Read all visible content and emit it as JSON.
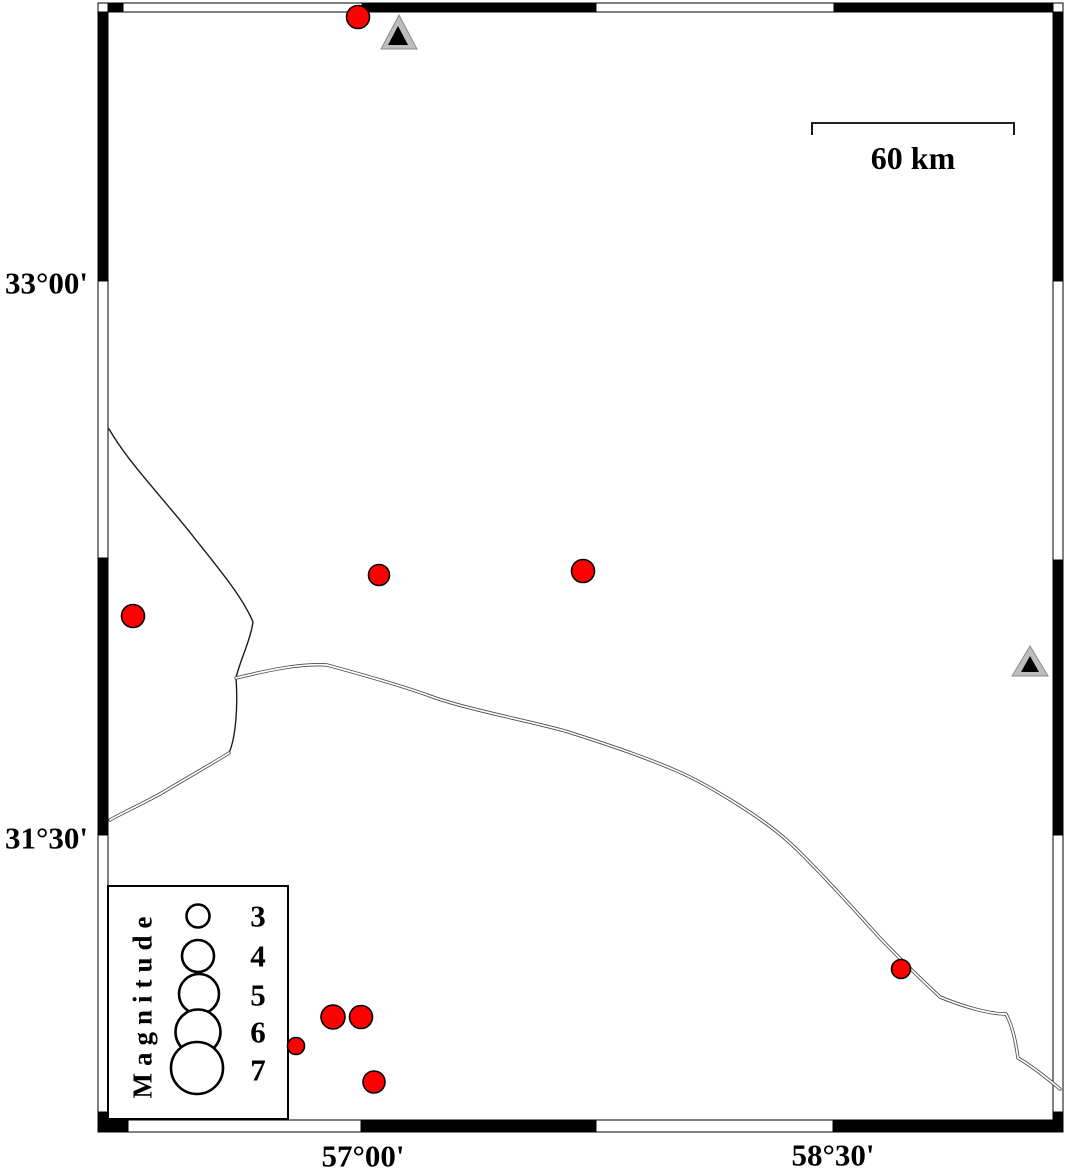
{
  "map": {
    "size": {
      "w": 1066,
      "h": 1171
    },
    "colors": {
      "earthquake_fill": "#ff0000",
      "marker_stroke": "#000000",
      "station_fill": "#bdbdbd",
      "station_inner": "#000000",
      "road_line": "#4a4a4a",
      "boundary_line": "#1c1c1c",
      "frame_black": "#000000",
      "frame_white": "#ffffff"
    },
    "labels": {
      "lat_top": "33°00'",
      "lat_bottom": "31°30'",
      "lon_left": "57°00'",
      "lon_right": "58°30'"
    },
    "label_positions": {
      "lat_top_y": 283,
      "lat_bottom_y": 838,
      "lon_left_x": 363,
      "lon_right_x": 833,
      "lon_y": 1156
    },
    "scale_bar": {
      "label": "60 km",
      "x1": 812,
      "x2": 1014,
      "y": 123,
      "tick_drop": 12,
      "label_x": 913,
      "label_y": 158
    },
    "frame": {
      "bars": [
        {
          "side": "top",
          "a1": 3,
          "a2": 12,
          "cells": [
            [
              98,
              108,
              "w"
            ],
            [
              108,
              123,
              "k"
            ],
            [
              123,
              362,
              "w"
            ],
            [
              362,
              596,
              "k"
            ],
            [
              596,
              834,
              "w"
            ],
            [
              834,
              1053,
              "k"
            ],
            [
              1053,
              1063,
              "w"
            ]
          ]
        },
        {
          "side": "bottom",
          "a1": 1120,
          "a2": 1132,
          "cells": [
            [
              98,
              128,
              "k"
            ],
            [
              128,
              361,
              "w"
            ],
            [
              361,
              596,
              "k"
            ],
            [
              596,
              833,
              "w"
            ],
            [
              833,
              1053,
              "k"
            ],
            [
              1053,
              1063,
              "w"
            ]
          ]
        },
        {
          "side": "left",
          "a1": 98,
          "a2": 108,
          "cells": [
            [
              12,
              281,
              "k"
            ],
            [
              281,
              558,
              "w"
            ],
            [
              558,
              835,
              "k"
            ],
            [
              835,
              1112,
              "w"
            ],
            [
              1112,
              1132,
              "k"
            ]
          ]
        },
        {
          "side": "right",
          "a1": 1053,
          "a2": 1063,
          "cells": [
            [
              3,
              12,
              "w"
            ],
            [
              12,
              281,
              "k"
            ],
            [
              281,
              560,
              "w"
            ],
            [
              560,
              835,
              "k"
            ],
            [
              835,
              1112,
              "w"
            ],
            [
              1112,
              1132,
              "k"
            ]
          ]
        }
      ]
    },
    "legend": {
      "title": "Magnitude",
      "box": {
        "x": 108,
        "y": 886,
        "w": 180,
        "h": 233
      },
      "title_x": 143,
      "title_y": 1004,
      "digit_x": 258,
      "entries": [
        {
          "label": "3",
          "cx": 198,
          "cy": 916,
          "r": 11.5
        },
        {
          "label": "4",
          "cx": 198,
          "cy": 956,
          "r": 16
        },
        {
          "label": "5",
          "cx": 199,
          "cy": 994,
          "r": 20
        },
        {
          "label": "6",
          "cx": 198,
          "cy": 1032,
          "r": 22.5
        },
        {
          "label": "7",
          "cx": 197,
          "cy": 1068,
          "r": 26
        }
      ]
    },
    "earthquakes": [
      {
        "cx": 358,
        "cy": 17,
        "r": 11.5
      },
      {
        "cx": 133,
        "cy": 616,
        "r": 11.5
      },
      {
        "cx": 379,
        "cy": 575,
        "r": 10.5
      },
      {
        "cx": 583,
        "cy": 571,
        "r": 11.5
      },
      {
        "cx": 296,
        "cy": 1046,
        "r": 8.5
      },
      {
        "cx": 333,
        "cy": 1017,
        "r": 12
      },
      {
        "cx": 361,
        "cy": 1017,
        "r": 11.5
      },
      {
        "cx": 374,
        "cy": 1082,
        "r": 11
      },
      {
        "cx": 901,
        "cy": 969,
        "r": 9.5
      }
    ],
    "stations": [
      {
        "outer": "399,15 381,49 417,49",
        "inner": "398,26 388,45 408,45"
      },
      {
        "outer": "1030,646 1012,676 1048,676",
        "inner": "1030,656 1021,672 1039,672"
      }
    ],
    "boundary_paths": [
      "M109,429 C130,465 165,500 196,540 C220,570 243,598 253,622 C250,642 240,660 236,678",
      "M236,678 C238,705 236,737 229,753"
    ],
    "road_paths": [
      "M236,678 C265,671 300,663 327,665 C360,674 400,685 430,696 C465,709 530,721 565,731 C610,745 645,757 677,771 C705,783 762,817 790,843 C815,866 850,905 870,927 C890,950 920,978 940,997 C962,1006 988,1014 1006,1014 C1012,1025 1016,1043 1018,1058 C1032,1066 1048,1079 1060,1089",
      "M229,753 C215,762 190,776 160,794 C140,805 122,813 110,820"
    ]
  },
  "chart_data": {
    "type": "map",
    "title": "",
    "region": {
      "lon_min": 56.15,
      "lon_max": 59.23,
      "lat_min": 30.72,
      "lat_max": 33.75
    },
    "graticule_annotations": {
      "latitudes": [
        "33°00'",
        "31°30'"
      ],
      "longitudes": [
        "57°00'",
        "58°30'"
      ]
    },
    "scale_bar_km": 60,
    "legend": {
      "title": "Magnitude",
      "magnitudes": [
        3,
        4,
        5,
        6,
        7
      ]
    },
    "earthquakes": [
      {
        "lon": 56.98,
        "lat": 33.71,
        "magnitude": 3.0
      },
      {
        "lon": 56.27,
        "lat": 32.09,
        "magnitude": 3.0
      },
      {
        "lon": 57.05,
        "lat": 32.2,
        "magnitude": 2.8
      },
      {
        "lon": 57.7,
        "lat": 32.21,
        "magnitude": 3.0
      },
      {
        "lon": 56.79,
        "lat": 30.93,
        "magnitude": 2.4
      },
      {
        "lon": 56.9,
        "lat": 31.01,
        "magnitude": 3.1
      },
      {
        "lon": 56.99,
        "lat": 31.01,
        "magnitude": 3.0
      },
      {
        "lon": 57.04,
        "lat": 30.83,
        "magnitude": 2.9
      },
      {
        "lon": 58.72,
        "lat": 31.14,
        "magnitude": 2.5
      }
    ],
    "stations": [
      {
        "lon": 57.11,
        "lat": 33.67
      },
      {
        "lon": 59.13,
        "lat": 31.96
      }
    ]
  }
}
